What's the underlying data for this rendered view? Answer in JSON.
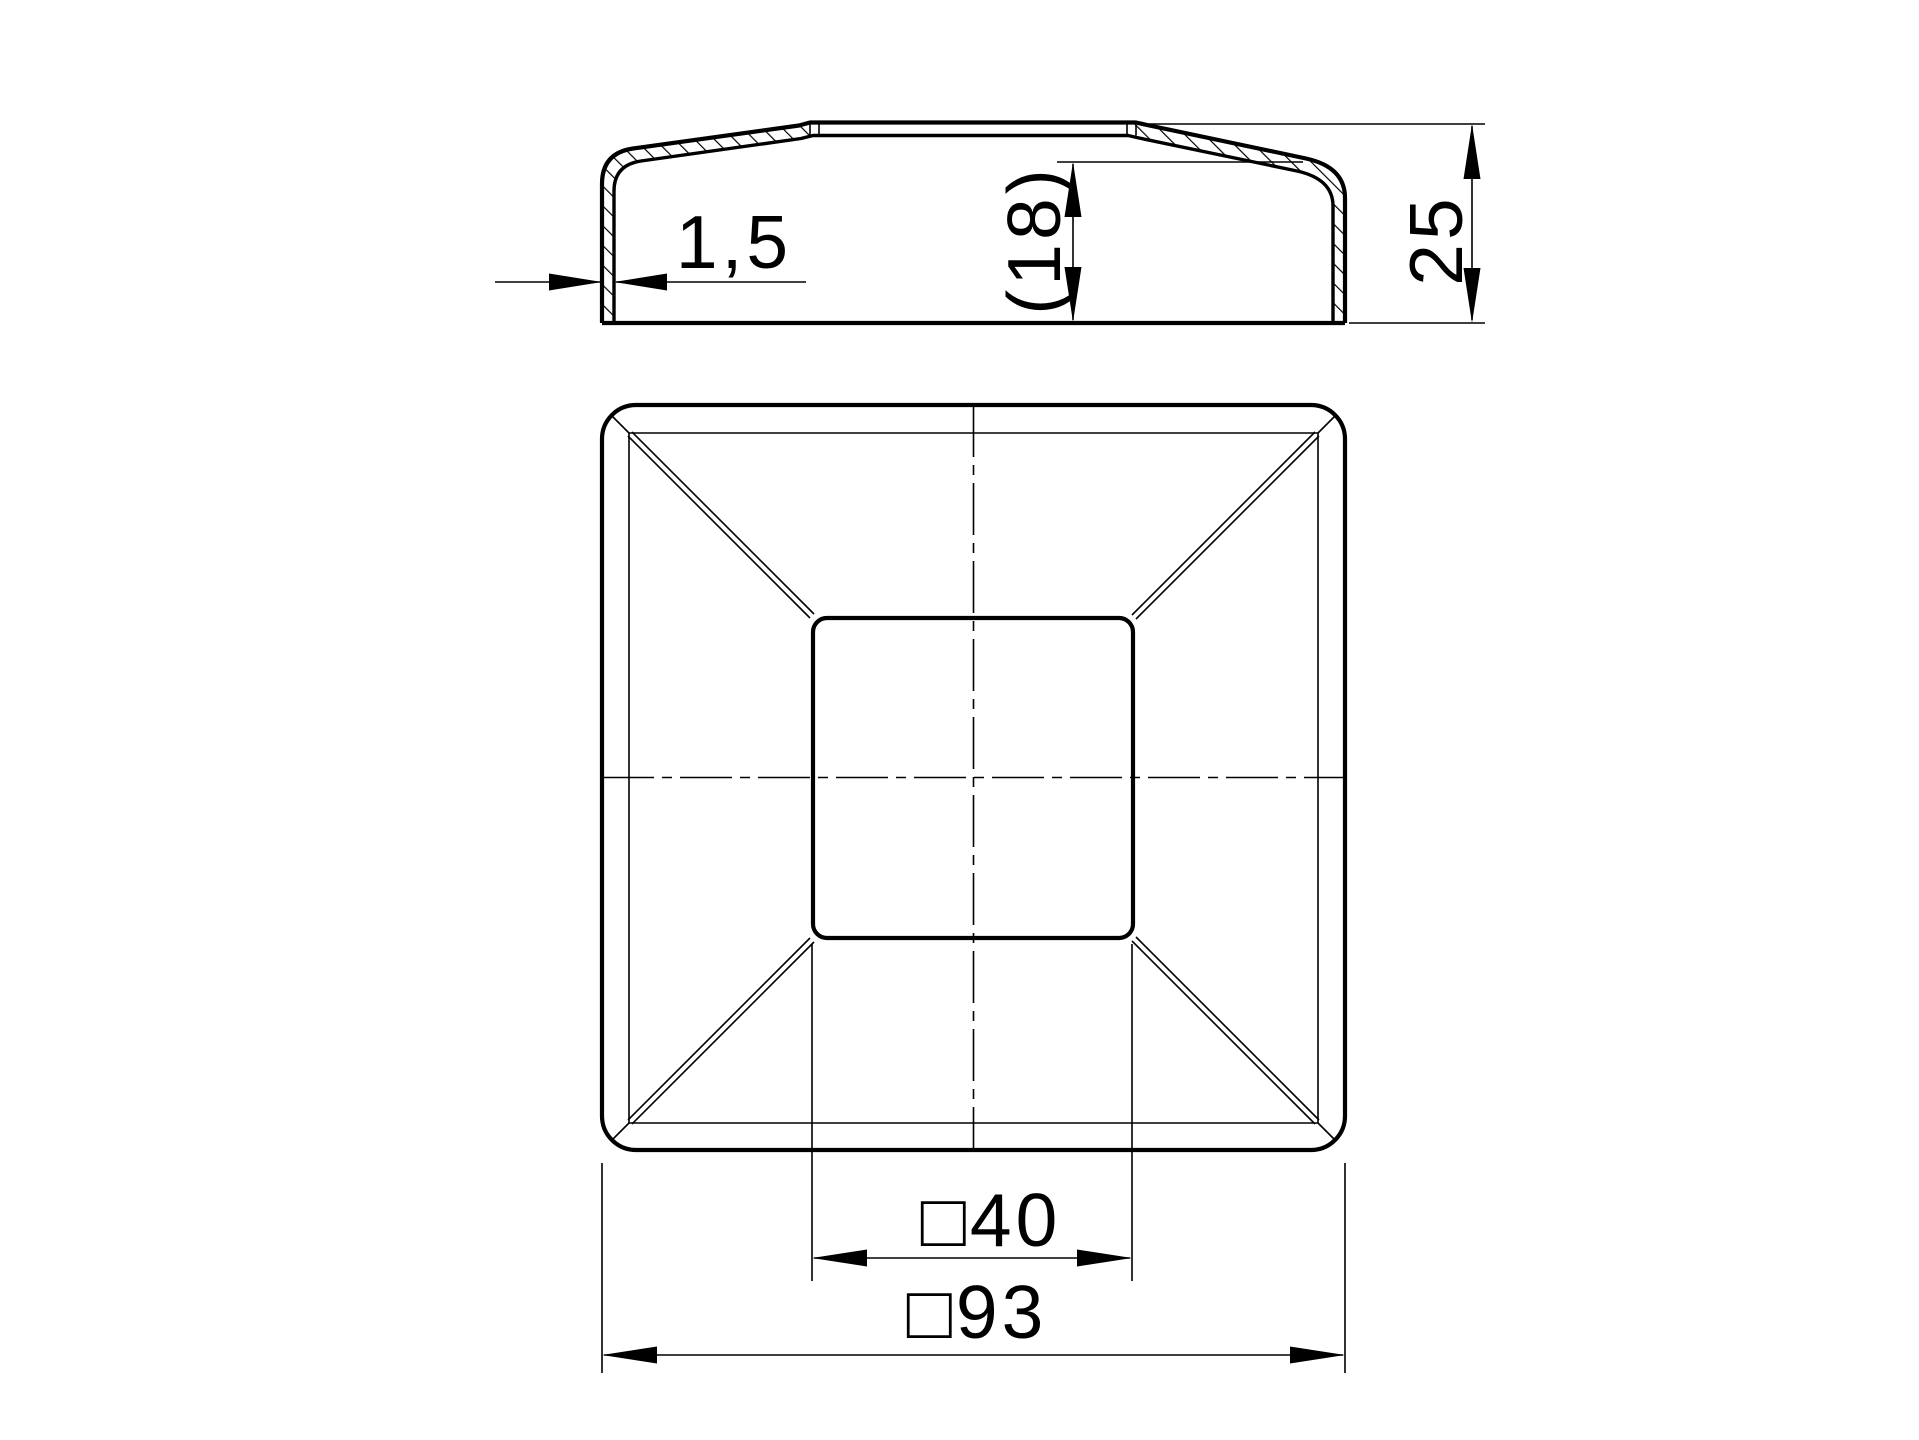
{
  "drawing": {
    "background_color": "#ffffff",
    "line_color": "#000000",
    "section_view": {
      "dim_wall_thickness": "1,5",
      "dim_cavity_depth_reference": "(18)",
      "dim_total_height": "25"
    },
    "plan_view": {
      "dim_inner_square": "□40",
      "dim_outer_square": "□93"
    }
  }
}
